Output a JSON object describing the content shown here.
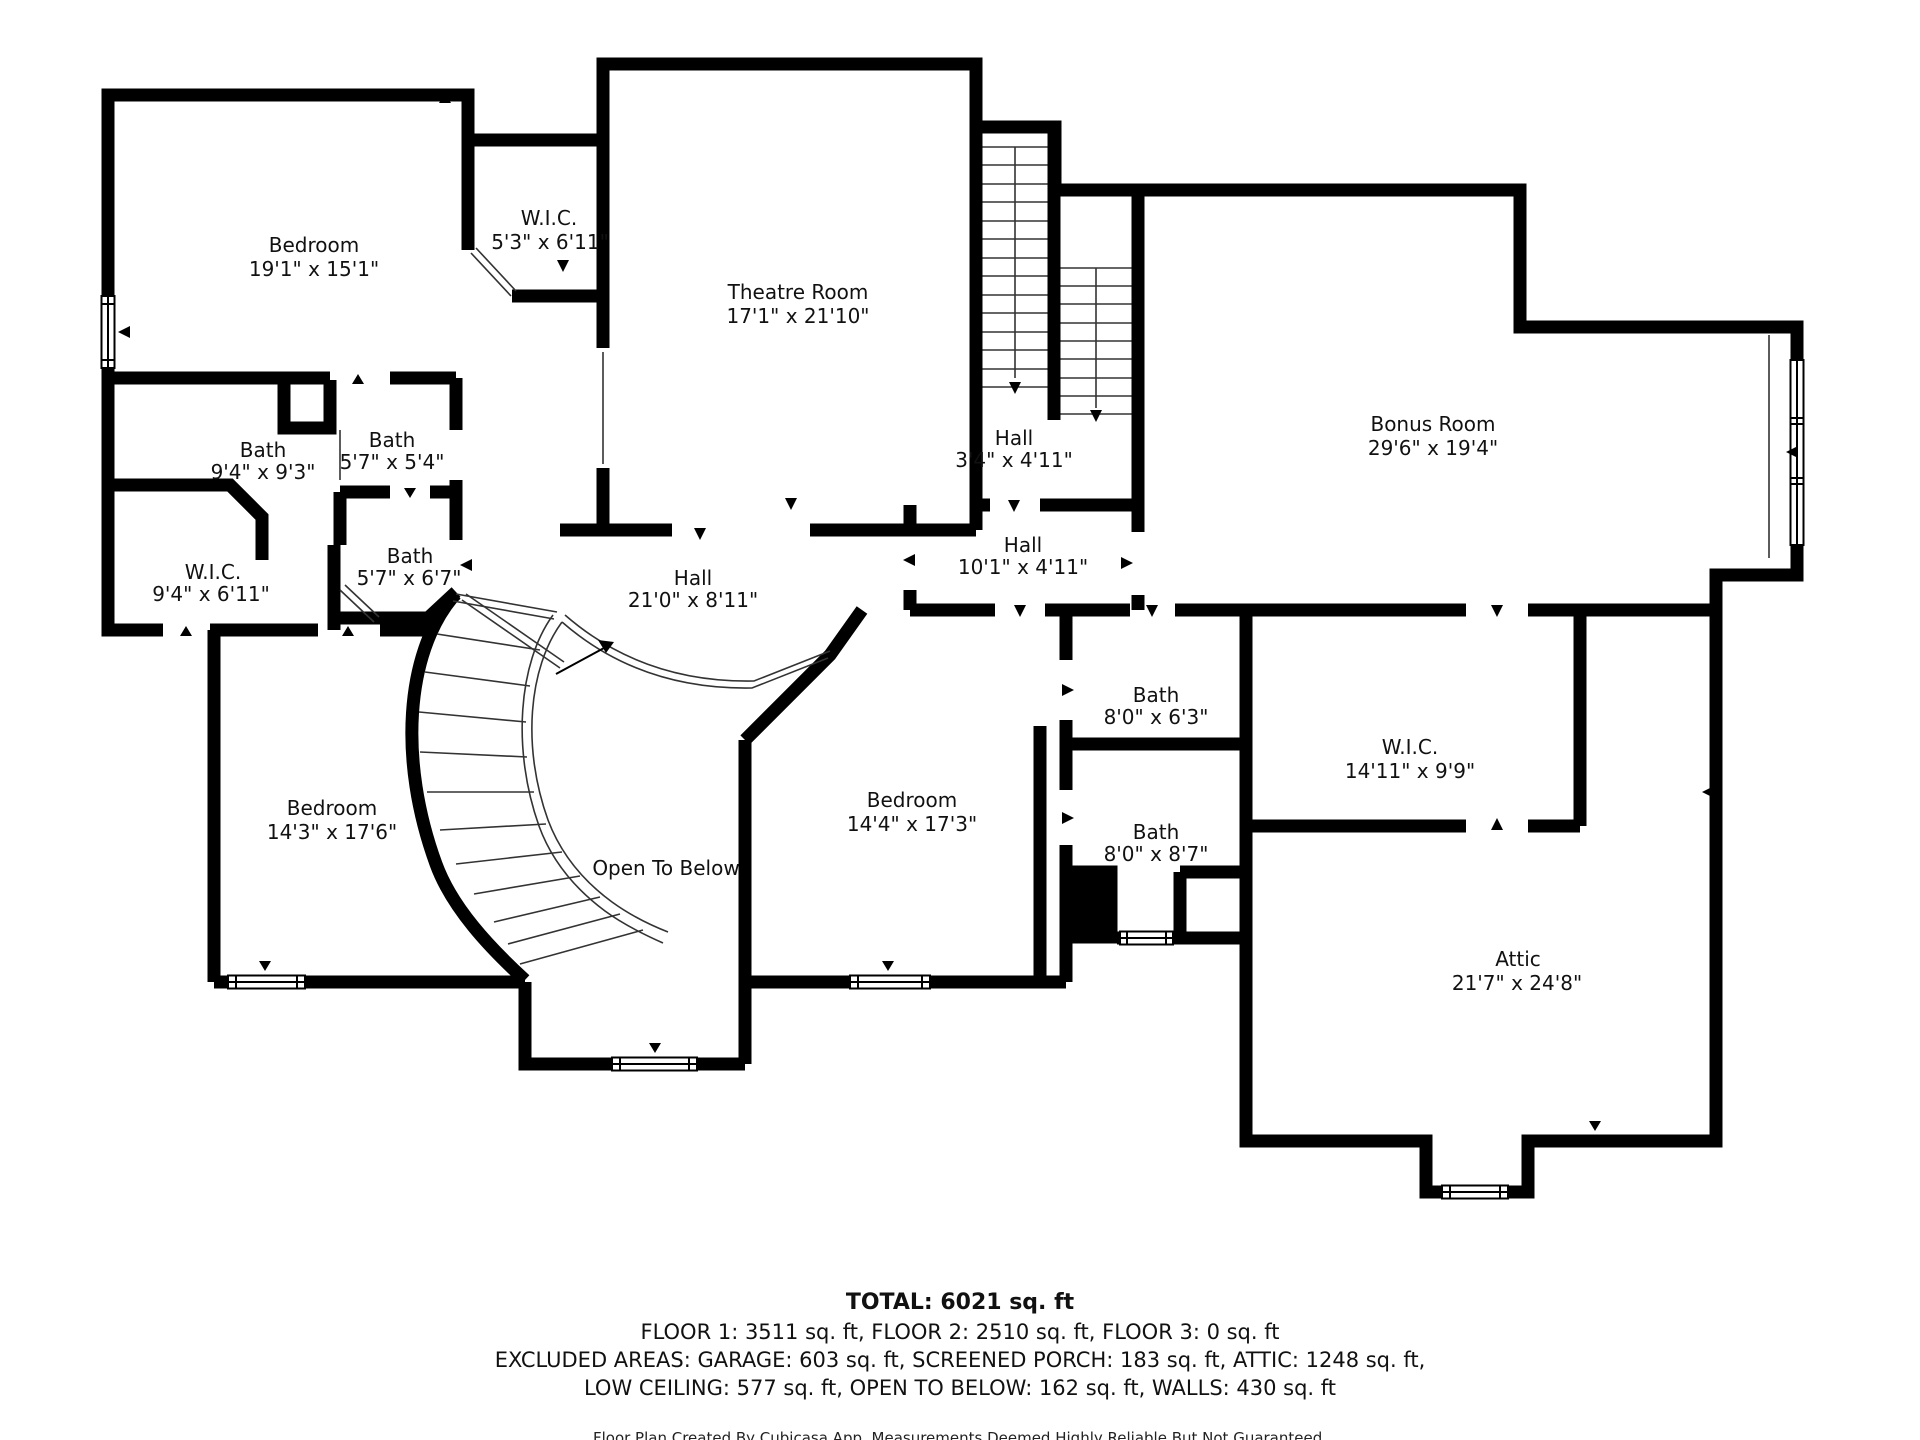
{
  "floorplan": {
    "rooms": [
      {
        "id": "bedroom-nw",
        "name": "Bedroom",
        "dims": "19'1\" x 15'1\""
      },
      {
        "id": "wic-nw",
        "name": "W.I.C.",
        "dims": "5'3\" x 6'11\""
      },
      {
        "id": "theatre-room",
        "name": "Theatre Room",
        "dims": "17'1\" x 21'10\""
      },
      {
        "id": "hall-stairs",
        "name": "Hall",
        "dims": "3'4\" x 4'11\""
      },
      {
        "id": "bonus-room",
        "name": "Bonus Room",
        "dims": "29'6\" x 19'4\""
      },
      {
        "id": "bath-nw",
        "name": "Bath",
        "dims": "9'4\" x 9'3\""
      },
      {
        "id": "bath-center-small",
        "name": "Bath",
        "dims": "5'7\" x 5'4\""
      },
      {
        "id": "wic-west",
        "name": "W.I.C.",
        "dims": "9'4\" x 6'11\""
      },
      {
        "id": "bath-center-lower",
        "name": "Bath",
        "dims": "5'7\" x 6'7\""
      },
      {
        "id": "hall-main",
        "name": "Hall",
        "dims": "21'0\" x 8'11\""
      },
      {
        "id": "hall-east",
        "name": "Hall",
        "dims": "10'1\" x 4'11\""
      },
      {
        "id": "bath-east-upper",
        "name": "Bath",
        "dims": "8'0\" x 6'3\""
      },
      {
        "id": "wic-east",
        "name": "W.I.C.",
        "dims": "14'11\" x 9'9\""
      },
      {
        "id": "bedroom-sw",
        "name": "Bedroom",
        "dims": "14'3\" x 17'6\""
      },
      {
        "id": "open-to-below",
        "name": "Open To Below",
        "dims": ""
      },
      {
        "id": "bedroom-s",
        "name": "Bedroom",
        "dims": "14'4\" x 17'3\""
      },
      {
        "id": "bath-s",
        "name": "Bath",
        "dims": "8'0\" x 8'7\""
      },
      {
        "id": "attic",
        "name": "Attic",
        "dims": "21'7\" x 24'8\""
      }
    ],
    "footer": {
      "total": "TOTAL: 6021 sq. ft",
      "floors": "FLOOR 1: 3511 sq. ft, FLOOR 2: 2510 sq. ft, FLOOR 3: 0 sq. ft",
      "excluded1": "EXCLUDED AREAS: GARAGE: 603 sq. ft, SCREENED PORCH: 183 sq. ft, ATTIC: 1248 sq. ft,",
      "excluded2": "LOW CEILING: 577 sq. ft, OPEN TO BELOW: 162 sq. ft, WALLS: 430 sq. ft",
      "disclaimer": "Floor Plan Created By Cubicasa App. Measurements Deemed Highly Reliable But Not Guaranteed."
    },
    "colors": {
      "wall": "#000000",
      "background": "#ffffff",
      "text": "#111111"
    }
  }
}
